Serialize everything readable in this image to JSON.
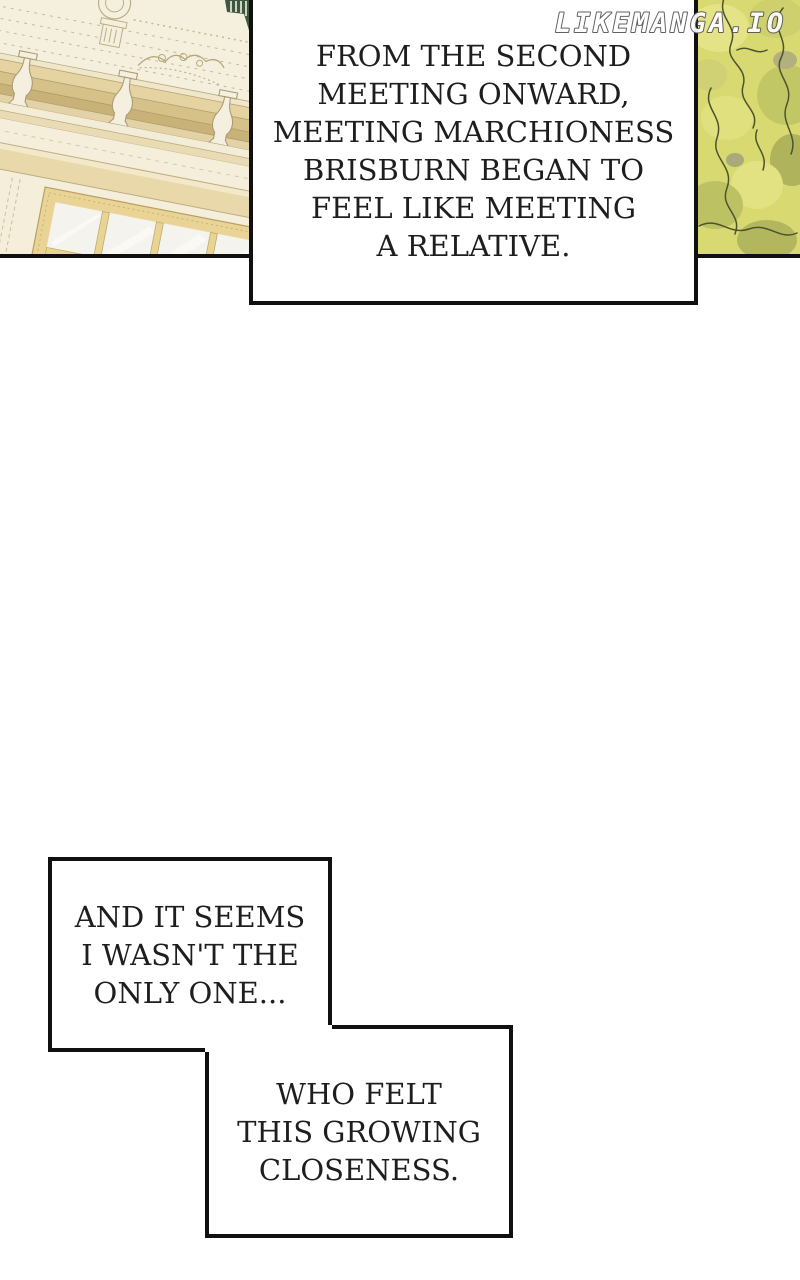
{
  "site_watermark": "LIKEMANGA.IO",
  "narration_box": {
    "full_text": "FROM THE SECOND MEETING ONWARD, MEETING MARCHIONESS BRISBURN BEGAN TO FEEL LIKE MEETING A RELATIVE.",
    "lines": [
      "FROM THE SECOND",
      "MEETING ONWARD,",
      "MEETING MARCHIONESS",
      "BRISBURN BEGAN TO",
      "FEEL LIKE MEETING",
      "A RELATIVE."
    ]
  },
  "speech_box_1": {
    "full_text": "AND IT SEEMS I WASN'T THE ONLY ONE...",
    "lines": [
      "AND IT SEEMS",
      "I WASN'T THE",
      "ONLY ONE..."
    ]
  },
  "speech_box_2": {
    "full_text": "WHO FELT THIS GROWING CLOSENESS.",
    "lines": [
      "WHO FELT",
      "THIS GROWING",
      "CLOSENESS."
    ]
  },
  "artwork": {
    "building_panel": "cream classical facade with balustrade, cornice and gold multi-pane window, tilted view",
    "foliage_panel": "yellow-green tree foliage with dark outline strokes",
    "colors": {
      "ink": "#101010",
      "paper": "#ffffff",
      "text": "#1e1e1e",
      "wall_cream": "#f5f0de",
      "cornice_beige": "#e3d0a0",
      "window_gold": "#e9d496",
      "pane_white": "#f4f3ed",
      "foliage_base": "#d8da71",
      "foliage_light": "#e4e487",
      "foliage_dark": "#aeb35c",
      "foliage_outline": "#4d532c",
      "hedge_dark_green": "#3f5740",
      "watermark_fill": "#ffffff",
      "watermark_outline": "#55565a"
    }
  }
}
